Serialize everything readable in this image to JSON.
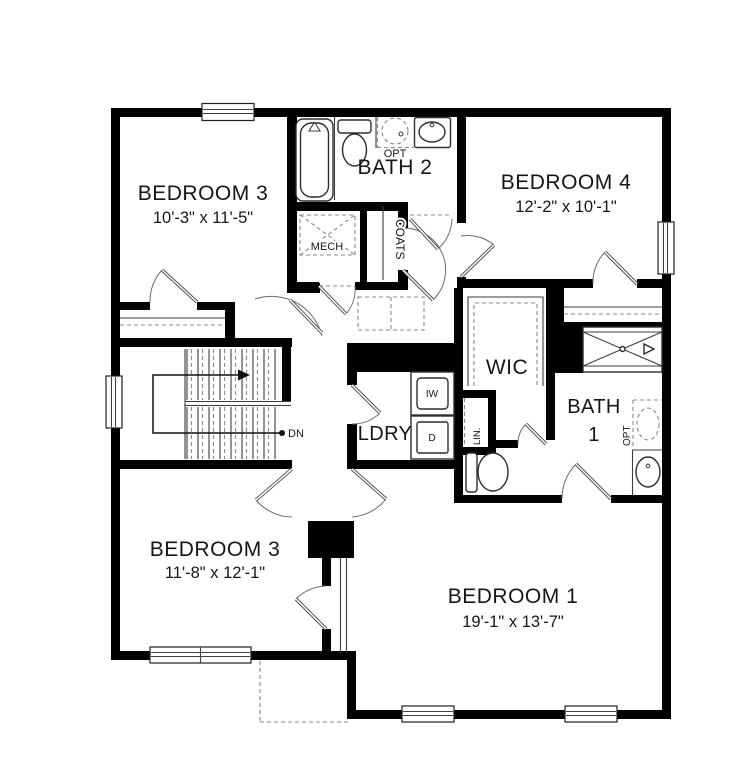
{
  "rooms": {
    "bedroom3_top": {
      "label": "BEDROOM 3",
      "dims": "10'-3\" x 11'-5\""
    },
    "bath2": {
      "label": "BATH 2"
    },
    "bedroom4": {
      "label": "BEDROOM 4",
      "dims": "12'-2\" x 10'-1\""
    },
    "wic": {
      "label": "WIC"
    },
    "bath1": {
      "line1": "BATH",
      "line2": "1"
    },
    "laundry": {
      "label": "LDRY"
    },
    "bedroom3_bottom": {
      "label": "BEDROOM 3",
      "dims": "11'-8\" x 12'-1\""
    },
    "bedroom1": {
      "label": "BEDROOM 1",
      "dims": "19'-1\" x 13'-7\""
    }
  },
  "closets": {
    "mech": "MECH",
    "coats": "COATS",
    "linen": "LIN."
  },
  "appliances": {
    "washer": "IW",
    "dryer": "D"
  },
  "annotations": {
    "down": "DN",
    "opt_bath2": "OPT",
    "opt_bath1": "OPT"
  },
  "colors": {
    "wall": "#000000",
    "line": "#3d3d3d",
    "door": "#6e6e6e",
    "dashed": "#8a8a8a",
    "text": "#161616",
    "background": "#ffffff"
  }
}
